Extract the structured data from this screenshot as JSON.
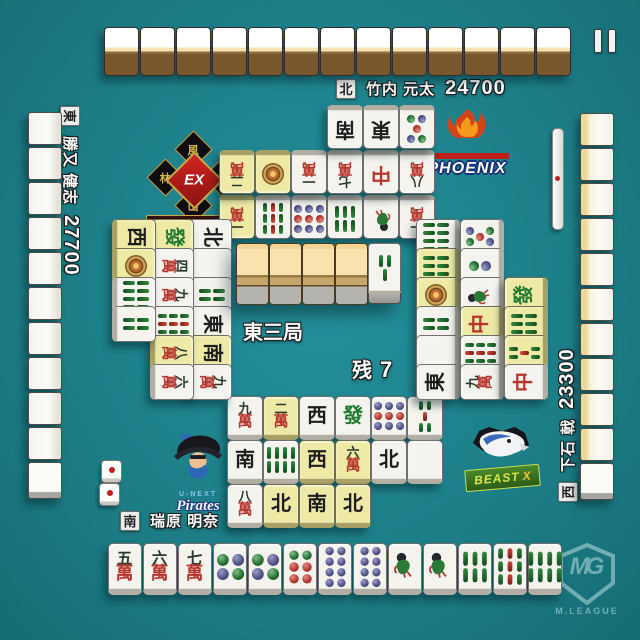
{
  "round": {
    "name": "東三局",
    "remaining_label": "残",
    "remaining_count": "7"
  },
  "players": {
    "north": {
      "seat": "北",
      "name": "竹内 元太",
      "score": "24700"
    },
    "east": {
      "seat": "東",
      "name": "勝又 健志",
      "score": "27700"
    },
    "south": {
      "seat": "南",
      "name": "瑞原 明奈",
      "score": "23300"
    },
    "west": {
      "seat": "西",
      "name": "下石 戟",
      "score": "23300"
    }
  },
  "center": {
    "dora_indicator": "3s",
    "dead_wall_face_down": 4
  },
  "hands": {
    "north_hidden": 13,
    "south": [
      "5m",
      "6m",
      "7m",
      "4p",
      "4p",
      "6p",
      "8p",
      "8p",
      "1s",
      "1s",
      "6s",
      "9s",
      "8s"
    ]
  },
  "discards": {
    "north": [
      [
        "1m*",
        "9s",
        "9p",
        "6s",
        "1s",
        "1m"
      ],
      [
        "2m*",
        "1p*",
        "1m",
        "7m",
        "C",
        "8m"
      ],
      [
        "S",
        "E",
        "5p"
      ]
    ],
    "east": [
      [
        "N",
        "P",
        "4s",
        "E",
        "S*",
        "9m"
      ],
      [
        "F*",
        "4m",
        "9m",
        "9s",
        "8m*",
        "6m"
      ],
      [
        "W*",
        "1p*",
        "8s",
        "4s"
      ]
    ],
    "south": [
      [
        "9m",
        "2m*",
        "W",
        "F",
        "9p",
        "5s"
      ],
      [
        "S",
        "8s",
        "W*",
        "6m*",
        "N",
        "P"
      ],
      [
        "8m",
        "N*",
        "S*",
        "N*"
      ]
    ],
    "west": [
      [
        "8s",
        "6s*",
        "1p*",
        "4s",
        "P",
        "E"
      ],
      [
        "5p",
        "2p",
        "1s",
        "C*",
        "9s",
        "9m"
      ],
      [
        "F*",
        "6s*",
        "5s*",
        "C"
      ]
    ]
  },
  "walls": {
    "left": 11,
    "right": 11
  },
  "riichi_stick": {
    "present": true
  },
  "dice": [
    1,
    1
  ],
  "logos": {
    "phoenix": {
      "text": "PHOENIX"
    },
    "furinkazan": {
      "ex": "EX",
      "banner": "FU-RIN-KA-ZAN",
      "kanji": [
        "風",
        "林",
        "火",
        "山"
      ]
    },
    "pirates": {
      "brand": "U-NEXT",
      "text": "Pirates"
    },
    "beast": {
      "text": "BEAST",
      "suffix": "X"
    }
  },
  "watermark": {
    "monogram": "MG",
    "label": "M.LEAGUE"
  },
  "colors": {
    "felt": "#1d7f88",
    "tile_white": "#f4f3ee",
    "tile_yellow": "#eeeaa6",
    "tile_back_brown": "#78572e",
    "accent_red": "#b6352c",
    "accent_green": "#236d2f",
    "accent_blue": "#4e5086"
  }
}
